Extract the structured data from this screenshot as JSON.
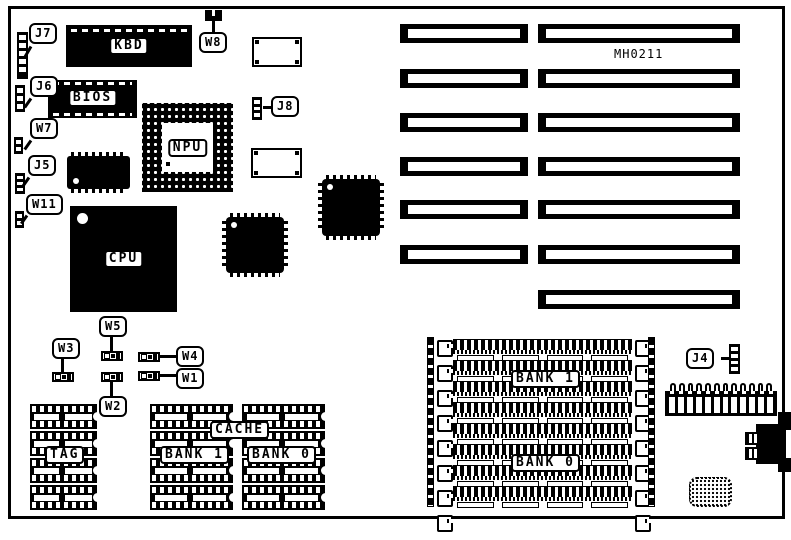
{
  "board": {
    "id": "MH0211"
  },
  "callouts": {
    "j7": "J7",
    "j6": "J6",
    "w7": "W7",
    "j5": "J5",
    "w11": "W11",
    "w8": "W8",
    "j8": "J8",
    "j4": "J4",
    "w1": "W1",
    "w2": "W2",
    "w3": "W3",
    "w4": "W4",
    "w5": "W5"
  },
  "chips": {
    "kbd": "KBD",
    "bios": "BIOS",
    "npu": "NPU",
    "cpu": "CPU"
  },
  "cache": {
    "tag": "TAG",
    "label": "CACHE",
    "bank1": "BANK 1",
    "bank0": "BANK 0"
  },
  "memory": {
    "bank1": "BANK 1",
    "bank0": "BANK 0"
  }
}
